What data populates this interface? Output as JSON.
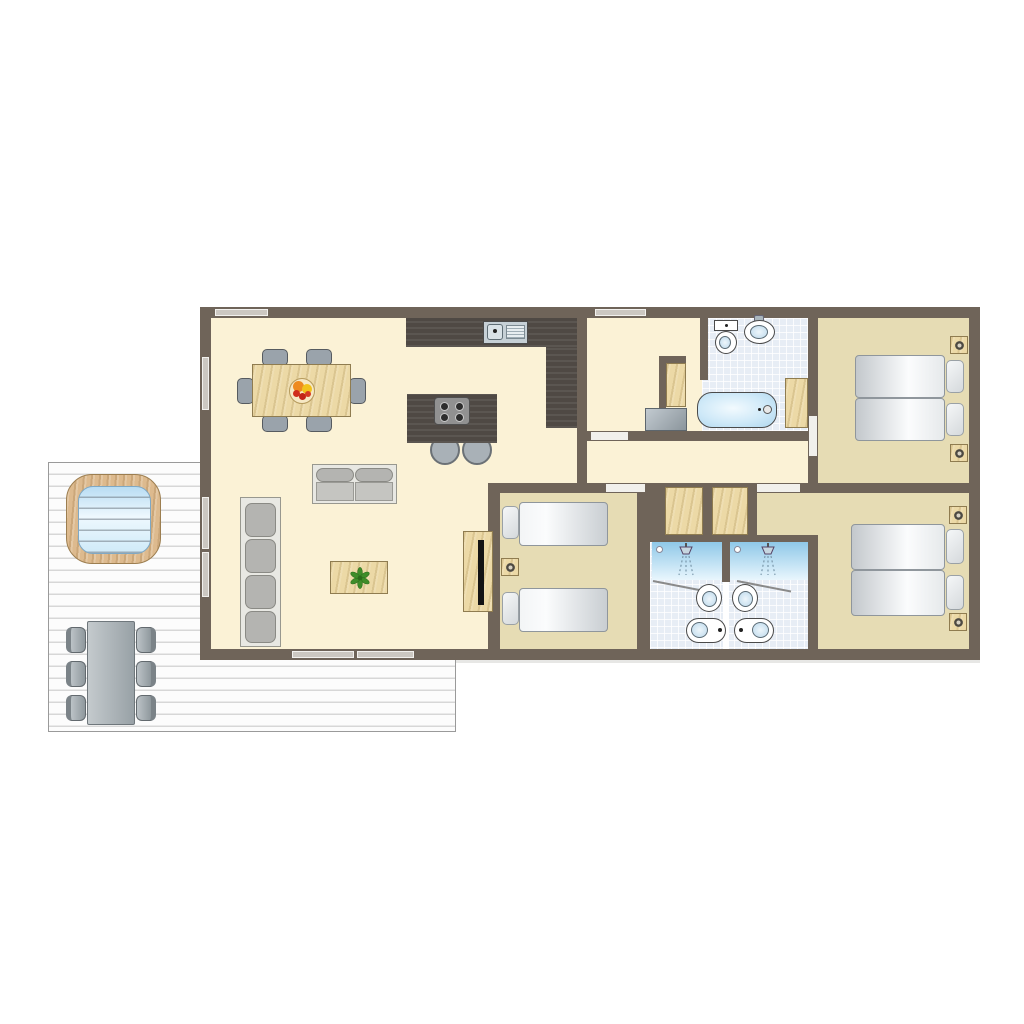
{
  "title": "Three-bedroom holiday lodge floor plan with deck (top-down view)",
  "palette": {
    "wall": "#6f6459",
    "living_floor": "#fbf2d6",
    "bedroom_floor": "#e6dcb4",
    "tile_floor": "#e7edf5",
    "wood": "#ecd9a6",
    "wood_trim": "#8f7c50",
    "counter": "#4f4944",
    "window_bar": "#ccc8c2",
    "door_opening": "#f1f0ec",
    "deck_board": "#fcfcfc",
    "deck_line": "#d7d7d7",
    "water": "#cfe9f8",
    "sofa": "#b4b4b1",
    "sofa_frame": "#e8e8e3",
    "chair": "#9aa3ab"
  },
  "rooms": [
    {
      "id": "living-kitchen",
      "label": "Open-plan living room, dining area and kitchen"
    },
    {
      "id": "entrance-hall",
      "label": "Entrance hall with closet and washing machine"
    },
    {
      "id": "family-bathroom",
      "label": "Bathroom with bathtub, toilet and washbasin"
    },
    {
      "id": "hallway",
      "label": "Hallway connecting bedrooms"
    },
    {
      "id": "bedroom-1",
      "label": "Double bedroom, top right (two singles pushed together)"
    },
    {
      "id": "bedroom-2",
      "label": "Twin bedroom, bottom left of wing"
    },
    {
      "id": "shower-room-1",
      "label": "Shower room with walk-in shower, basin and toilet"
    },
    {
      "id": "shower-room-2",
      "label": "Shower room with walk-in shower, basin and toilet"
    },
    {
      "id": "bedroom-3",
      "label": "Double bedroom, bottom right (two singles pushed together)"
    },
    {
      "id": "deck",
      "label": "Outdoor timber deck"
    }
  ],
  "contents": {
    "living_kitchen": [
      "dining table with fruit bowl and 6 chairs",
      "L-shaped dark kitchen counter with sink and drainer",
      "kitchen island with 4-burner hob and 2 bar stools",
      "2-seat sofa",
      "4-cushion chaise sofa",
      "coffee table with plant",
      "TV sideboard with television"
    ],
    "family_bathroom": [
      "bathtub with tap",
      "toilet with cistern",
      "oval washbasin with tap",
      "linen closet",
      "washing machine",
      "wardrobe"
    ],
    "bedroom_1": [
      "two single beds with pillows",
      "two nightstands with lamps"
    ],
    "bedroom_2": [
      "two single beds with pillows",
      "one nightstand with lamp"
    ],
    "bedroom_3": [
      "two single beds with pillows",
      "two nightstands with lamps",
      "entry alcove"
    ],
    "shower_rooms": [
      "walk-in shower with glass door and drain",
      "oval washbasin",
      "toilet"
    ],
    "wardrobe_lobby": [
      "two built-in wardrobes between hallway and shower rooms"
    ],
    "deck": [
      "hot tub with wooden rim",
      "outdoor dining table with 6 chairs"
    ]
  },
  "openings": {
    "windows_top_wall": 2,
    "windows_left_wall": 3,
    "patio_doors_living_rear": 2,
    "interior_door_openings": 4
  }
}
